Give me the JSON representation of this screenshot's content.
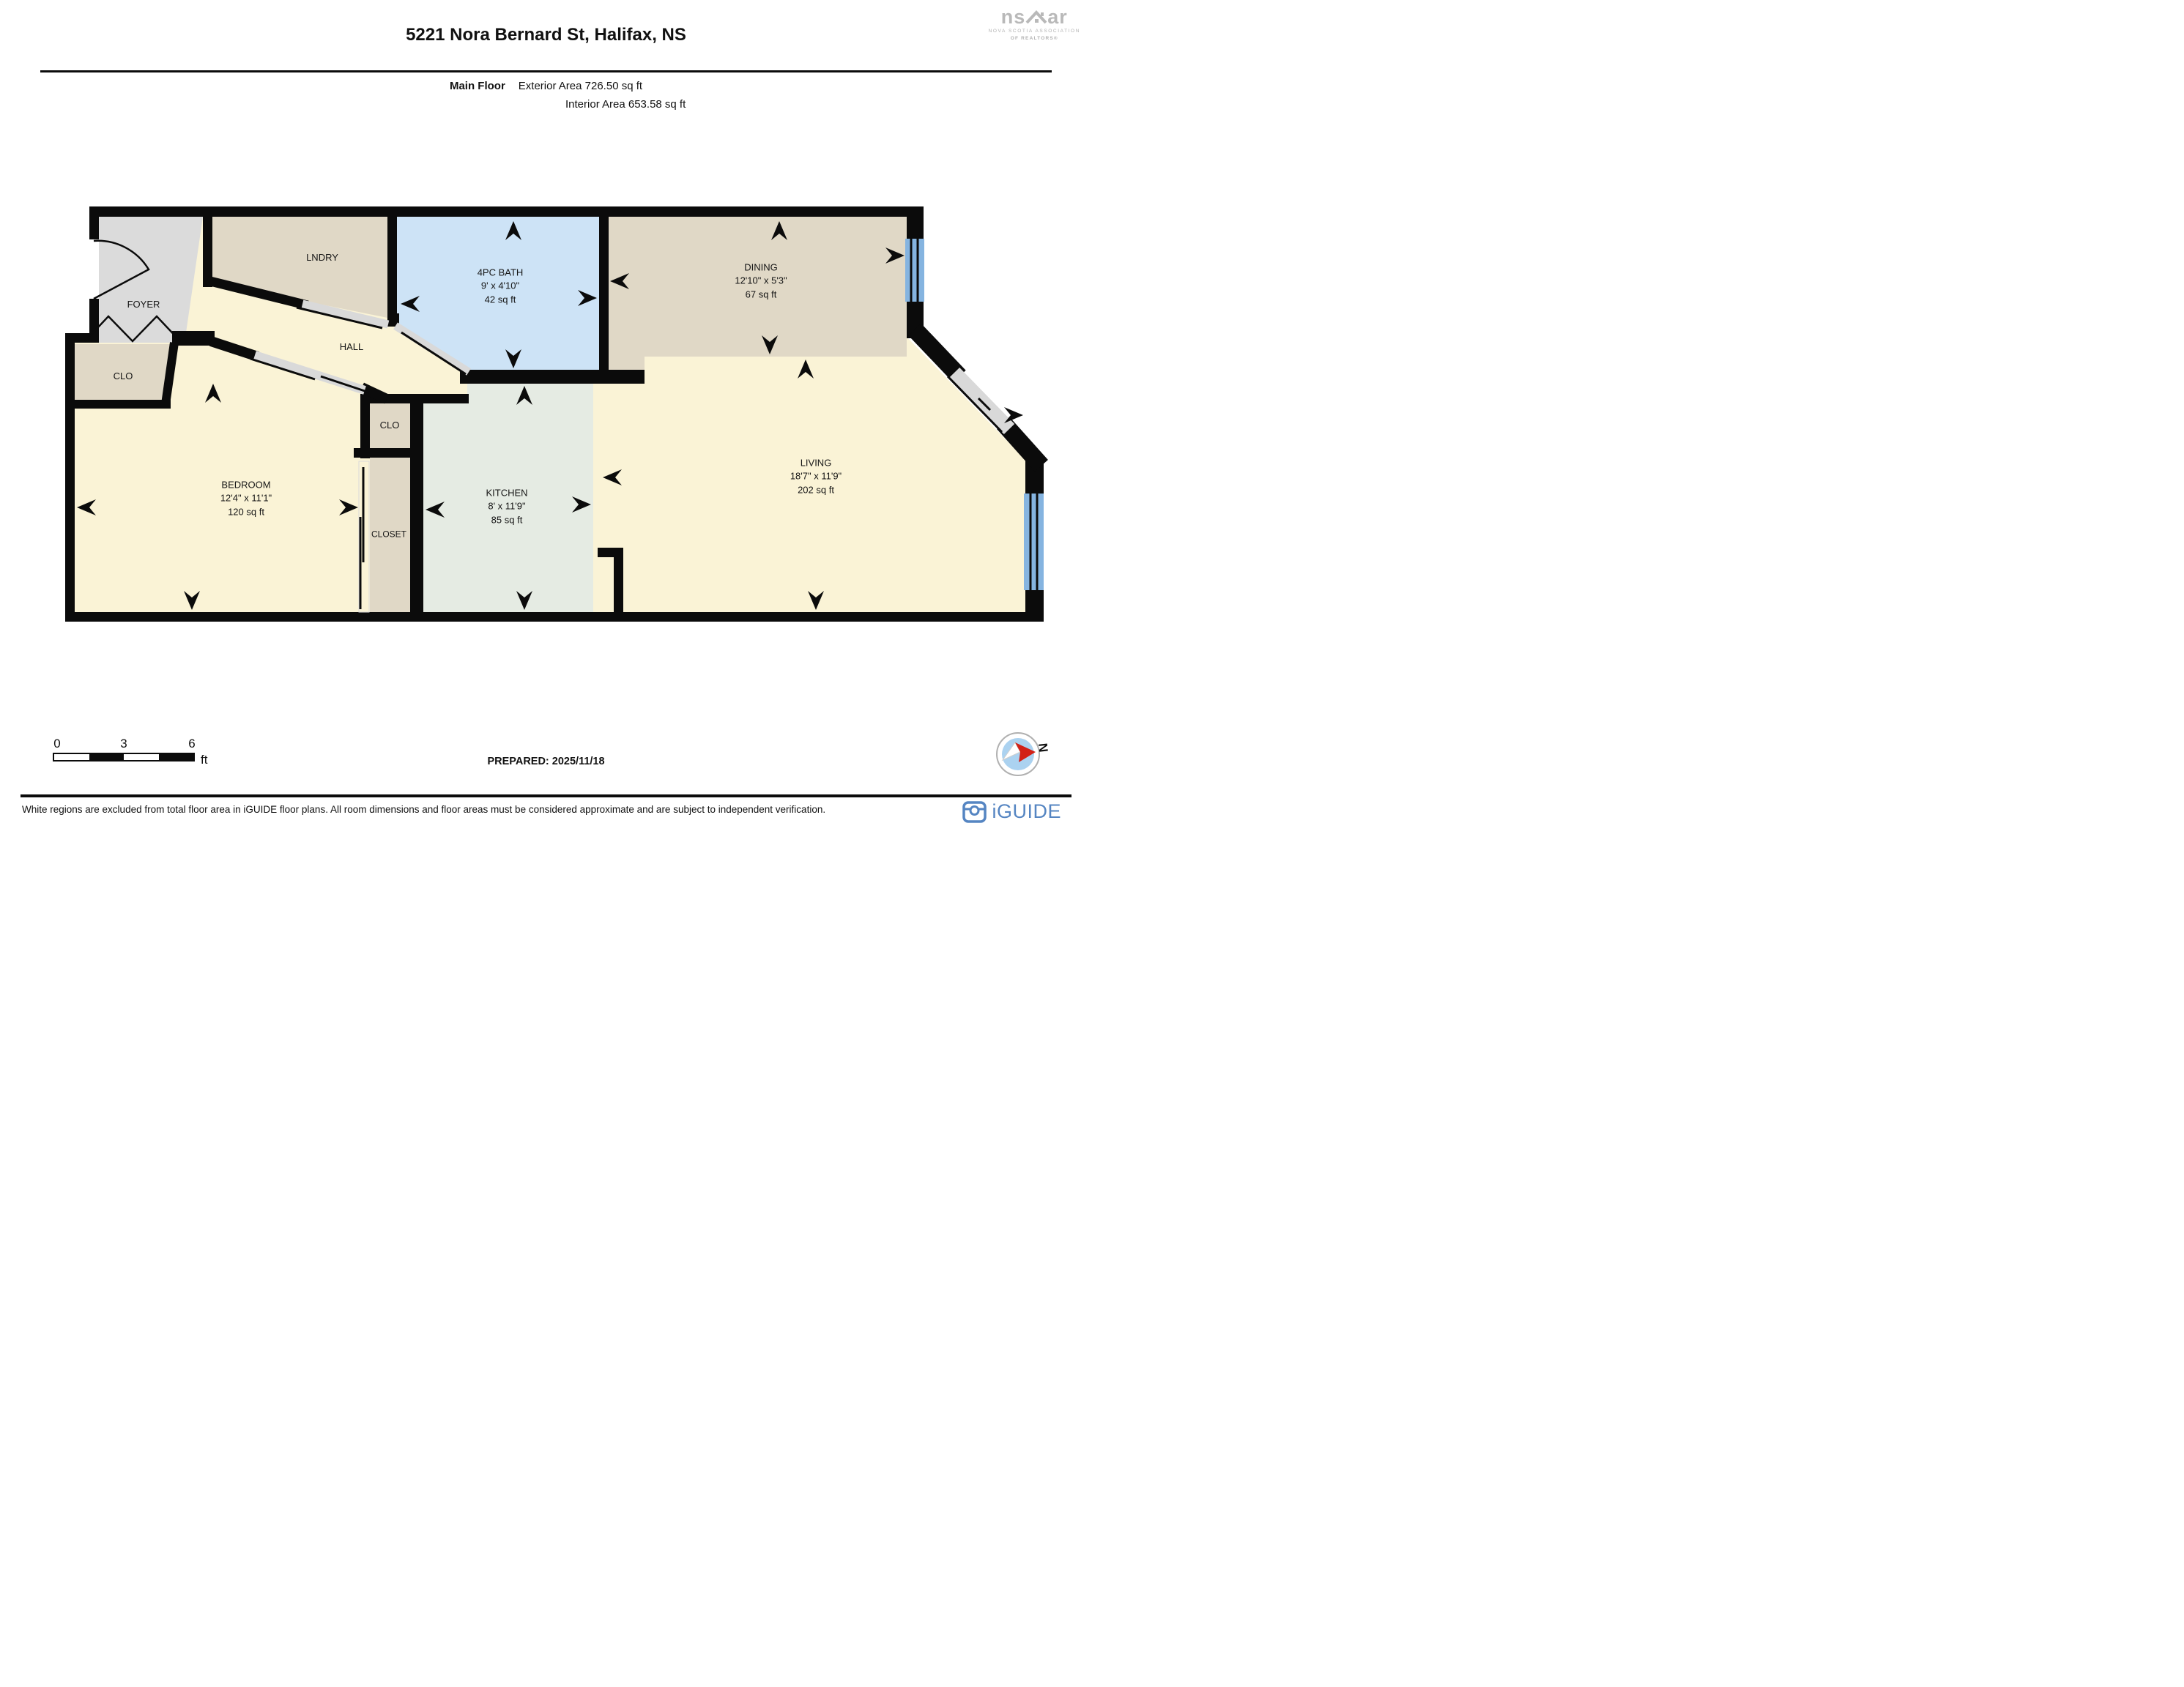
{
  "header": {
    "title": "5221 Nora Bernard St, Halifax, NS",
    "floor_label": "Main Floor",
    "exterior_area": "Exterior Area 726.50 sq ft",
    "interior_area": "Interior Area 653.58 sq ft"
  },
  "nsar_logo": {
    "brand_left": "ns",
    "brand_right": "ar",
    "line1": "NOVA SCOTIA ASSOCIATION",
    "line2": "OF REALTORS®"
  },
  "rooms": {
    "foyer": {
      "name": "FOYER"
    },
    "laundry": {
      "name": "LNDRY"
    },
    "bath": {
      "name": "4PC BATH",
      "dims": "9' x 4'10\"",
      "area": "42 sq ft"
    },
    "dining": {
      "name": "DINING",
      "dims": "12'10\" x 5'3\"",
      "area": "67 sq ft"
    },
    "hall": {
      "name": "HALL"
    },
    "closet_entry": {
      "name": "CLO"
    },
    "bedroom": {
      "name": "BEDROOM",
      "dims": "12'4\" x 11'1\"",
      "area": "120 sq ft"
    },
    "closet_small": {
      "name": "CLO"
    },
    "closet": {
      "name": "CLOSET"
    },
    "kitchen": {
      "name": "KITCHEN",
      "dims": "8' x 11'9\"",
      "area": "85 sq ft"
    },
    "living": {
      "name": "LIVING",
      "dims": "18'7\" x 11'9\"",
      "area": "202 sq ft"
    }
  },
  "scale_bar": {
    "labels": [
      "0",
      "3",
      "6"
    ],
    "unit": "ft"
  },
  "compass": {
    "north_label": "N"
  },
  "footer": {
    "prepared": "PREPARED: 2025/11/18",
    "disclaimer": "White regions are excluded from total floor area in iGUIDE floor plans. All room dimensions and floor areas must be considered approximate and are subject to independent verification.",
    "brand": "iGUIDE"
  },
  "colors": {
    "wall": "#0b0b0b",
    "cream": "#faf3d6",
    "tan": "#e0d8c6",
    "bath_blue": "#cde3f6",
    "kitchen_green": "#e5ebe3",
    "foyer_gray": "#dbdbdb",
    "window_blue": "#85b4e0",
    "door_gray": "#d9d9d9",
    "brand_blue": "#5585c2",
    "compass_red": "#d22117"
  }
}
